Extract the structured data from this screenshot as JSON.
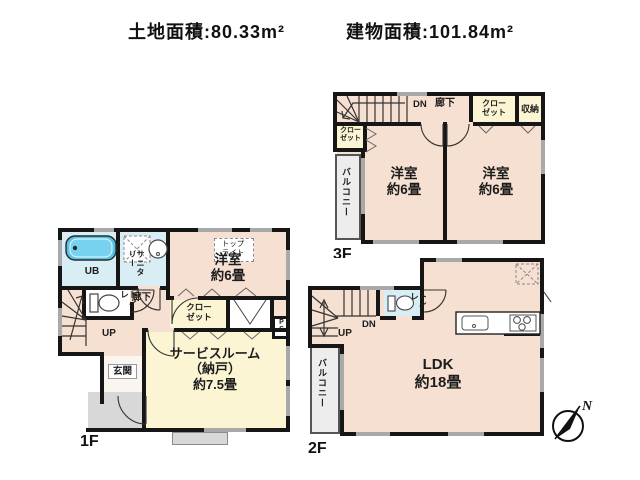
{
  "header": {
    "land_area": "土地面積:80.33m²",
    "building_area": "建物面積:101.84m²"
  },
  "floor_1f": {
    "floor_label": "1F",
    "ub": "UB",
    "sanitary": "サニタリー",
    "toilet": "トイレ",
    "hallway": "廊下",
    "stairs_up": "UP",
    "entrance": "玄関",
    "closet": "クロー\nゼット",
    "pipe_space": "PS",
    "skylight": "トップ\nライト",
    "western_room": "洋室\n約6畳",
    "service_room": "サービスルーム\n（納戸）\n約7.5畳"
  },
  "floor_2f": {
    "floor_label": "2F",
    "stairs_up": "UP",
    "stairs_down": "DN",
    "toilet": "トイレ",
    "balcony": "バルコニー",
    "ldk": "LDK\n約18畳"
  },
  "floor_3f": {
    "floor_label": "3F",
    "stairs_down": "DN",
    "hallway": "廊下",
    "closet_left": "クロー\nゼット",
    "closet_right": "クロー\nゼット",
    "storage": "収納",
    "balcony": "バルコニー",
    "western_room_left": "洋室\n約6畳",
    "western_room_right": "洋室\n約6畳"
  },
  "compass": {
    "north": "N"
  },
  "colors": {
    "wall": "#161616",
    "room": "#f6e0d1",
    "closet": "#fbf5d4",
    "wet": "#d9edf5",
    "bathtub": "#55c3e8",
    "balcony": "#ededed",
    "porch": "#d8d8d8",
    "window": "#a9a9a9"
  }
}
